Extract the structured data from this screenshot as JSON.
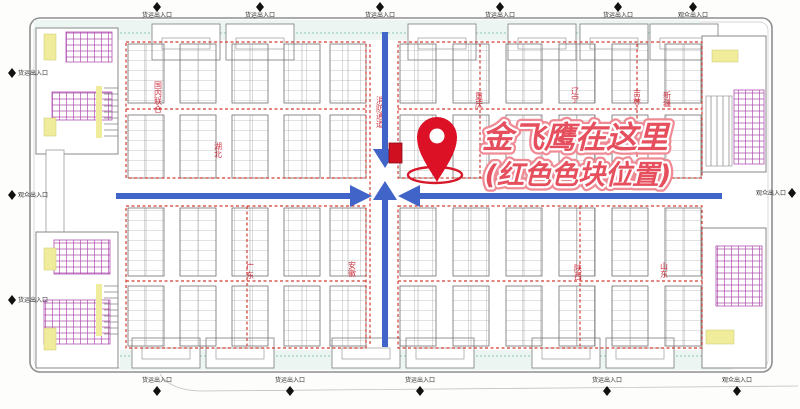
{
  "annotation": {
    "line1": "金飞鹰在这里",
    "line2": "(红色色块位置)"
  },
  "gates": {
    "top": [
      {
        "x": 157,
        "label": "货运出入口"
      },
      {
        "x": 260,
        "label": "货运出入口"
      },
      {
        "x": 380,
        "label": "货运出入口"
      },
      {
        "x": 500,
        "label": "货运出入口"
      },
      {
        "x": 618,
        "label": "货运出入口"
      },
      {
        "x": 693,
        "label": "观众出入口"
      }
    ],
    "bottom": [
      {
        "x": 157,
        "label": "货运出入口"
      },
      {
        "x": 290,
        "label": "货运出入口"
      },
      {
        "x": 420,
        "label": "货运出入口"
      },
      {
        "x": 607,
        "label": "货运出入口"
      },
      {
        "x": 737,
        "label": "观众出入口"
      }
    ],
    "left": [
      {
        "y": 73,
        "label": "货运出入口"
      },
      {
        "y": 195,
        "label": "观众出入口"
      },
      {
        "y": 300,
        "label": "货运出入口"
      }
    ],
    "right": [
      {
        "y": 193,
        "label": "观众出入口"
      }
    ]
  },
  "regions": [
    {
      "label": "国内联合",
      "x": 158,
      "y": 97
    },
    {
      "label": "湖北",
      "x": 218,
      "y": 150
    },
    {
      "label": "广东",
      "x": 250,
      "y": 271
    },
    {
      "label": "安徽",
      "x": 352,
      "y": 269
    },
    {
      "label": "消防通道",
      "x": 380,
      "y": 112
    },
    {
      "label": "重庆",
      "x": 479,
      "y": 100
    },
    {
      "label": "辽宁",
      "x": 575,
      "y": 95
    },
    {
      "label": "吉林",
      "x": 637,
      "y": 97
    },
    {
      "label": "新疆",
      "x": 667,
      "y": 99
    },
    {
      "label": "陕西",
      "x": 578,
      "y": 272
    },
    {
      "label": "山东",
      "x": 664,
      "y": 270
    }
  ],
  "colors": {
    "arrow_blue": "#4064c8",
    "pin_red": "#dc1126",
    "highlight_red": "#cf1020",
    "text_red": "#e95864",
    "booth_dash_red": "#d33c32",
    "facility_magenta": "#b050b0",
    "accent_yellow": "#efec9b",
    "corridor_teal": "#8cc8b8",
    "wall_gray": "#8f8f8f"
  }
}
